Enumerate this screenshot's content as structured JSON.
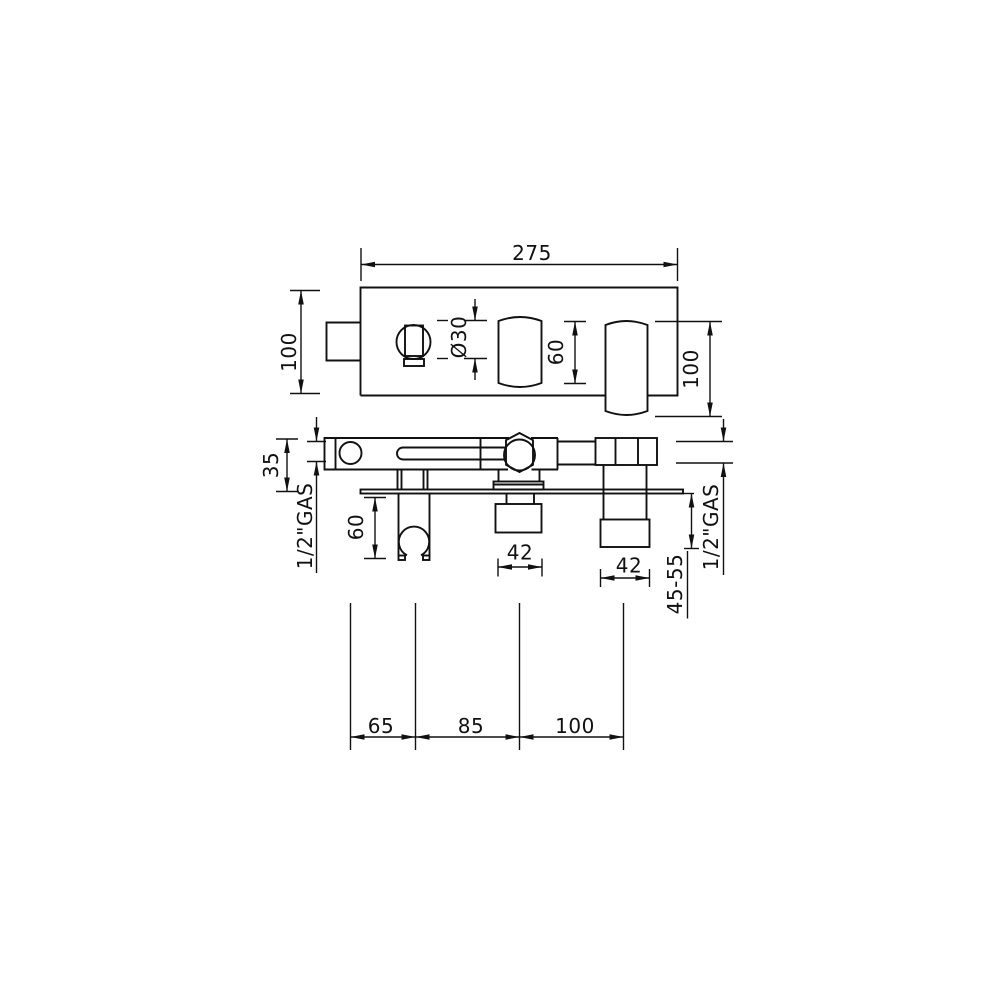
{
  "page": {
    "background": "#ffffff",
    "line_color": "#111111",
    "description": "Technical dimension drawing of wall-mounted bath/shower mixer, top view and front view"
  },
  "top_view": {
    "overall_width": "275",
    "overall_height": "100",
    "knob_diameter": "Ø30",
    "handle_length": "60",
    "spout_length": "100"
  },
  "front_view": {
    "body_height": "35",
    "inlet_left": "1/2\"GAS",
    "inlet_right": "1/2\"GAS",
    "holder_drop": "60",
    "outlet_width": "42",
    "spout_width": "42",
    "wall_projection": "45-55"
  },
  "spacings": [
    "65",
    "85",
    "100"
  ]
}
